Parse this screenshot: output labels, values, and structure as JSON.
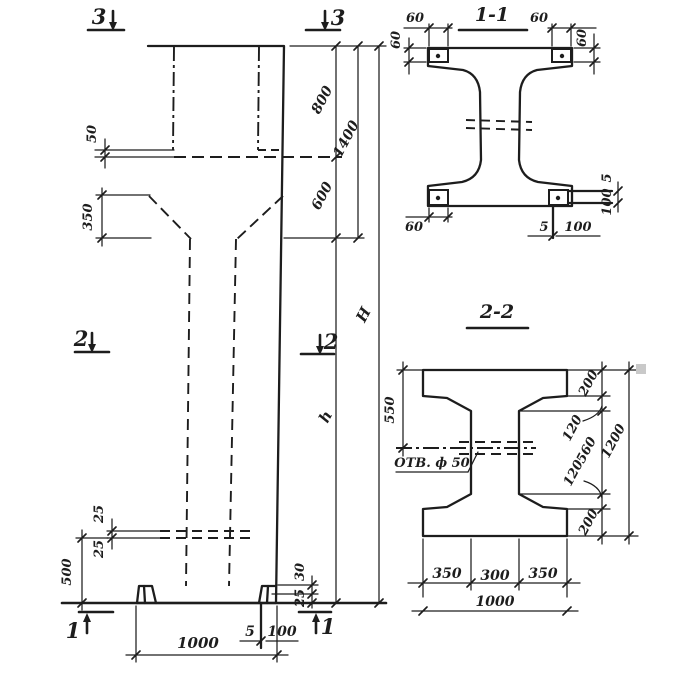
{
  "drawing_type": "structural column shop drawing",
  "colors": {
    "ink": "#1d1d1d",
    "paper": "#ffffff"
  },
  "elevation": {
    "marker_3_left": "3",
    "marker_3_right": "3",
    "marker_2_left": "2",
    "marker_2_right": "2",
    "marker_1_left": "1",
    "marker_1_right": "1",
    "dim_50": "50",
    "dim_350": "350",
    "dim_800": "800",
    "dim_1400": "1400",
    "dim_600": "600",
    "dim_H": "H",
    "dim_h": "h",
    "dim_25_top": "25",
    "dim_25_bot": "25",
    "dim_500": "500",
    "dim_30": "30",
    "dim_25_corbel": "25",
    "dim_5": "5",
    "dim_100": "100",
    "dim_1000": "1000"
  },
  "section_1_1": {
    "title": "1-1",
    "dim_60_top_left": "60",
    "dim_60_left": "60",
    "dim_60_top_right": "60",
    "dim_60_right": "60",
    "dim_60_bottom": "60",
    "dim_5_bottom": "5",
    "dim_100_bottom": "100",
    "dim_5_tab": "5",
    "dim_100_tab": "100"
  },
  "section_2_2": {
    "title": "2-2",
    "hole_label": "ОТВ. ф 50",
    "dim_550": "550",
    "dim_200_top": "200",
    "dim_120_top": "120",
    "dim_560": "560",
    "dim_120_bot": "120",
    "dim_200_bot": "200",
    "dim_1200": "1200",
    "dim_350_left": "350",
    "dim_300": "300",
    "dim_350_right": "350",
    "dim_1000": "1000"
  }
}
